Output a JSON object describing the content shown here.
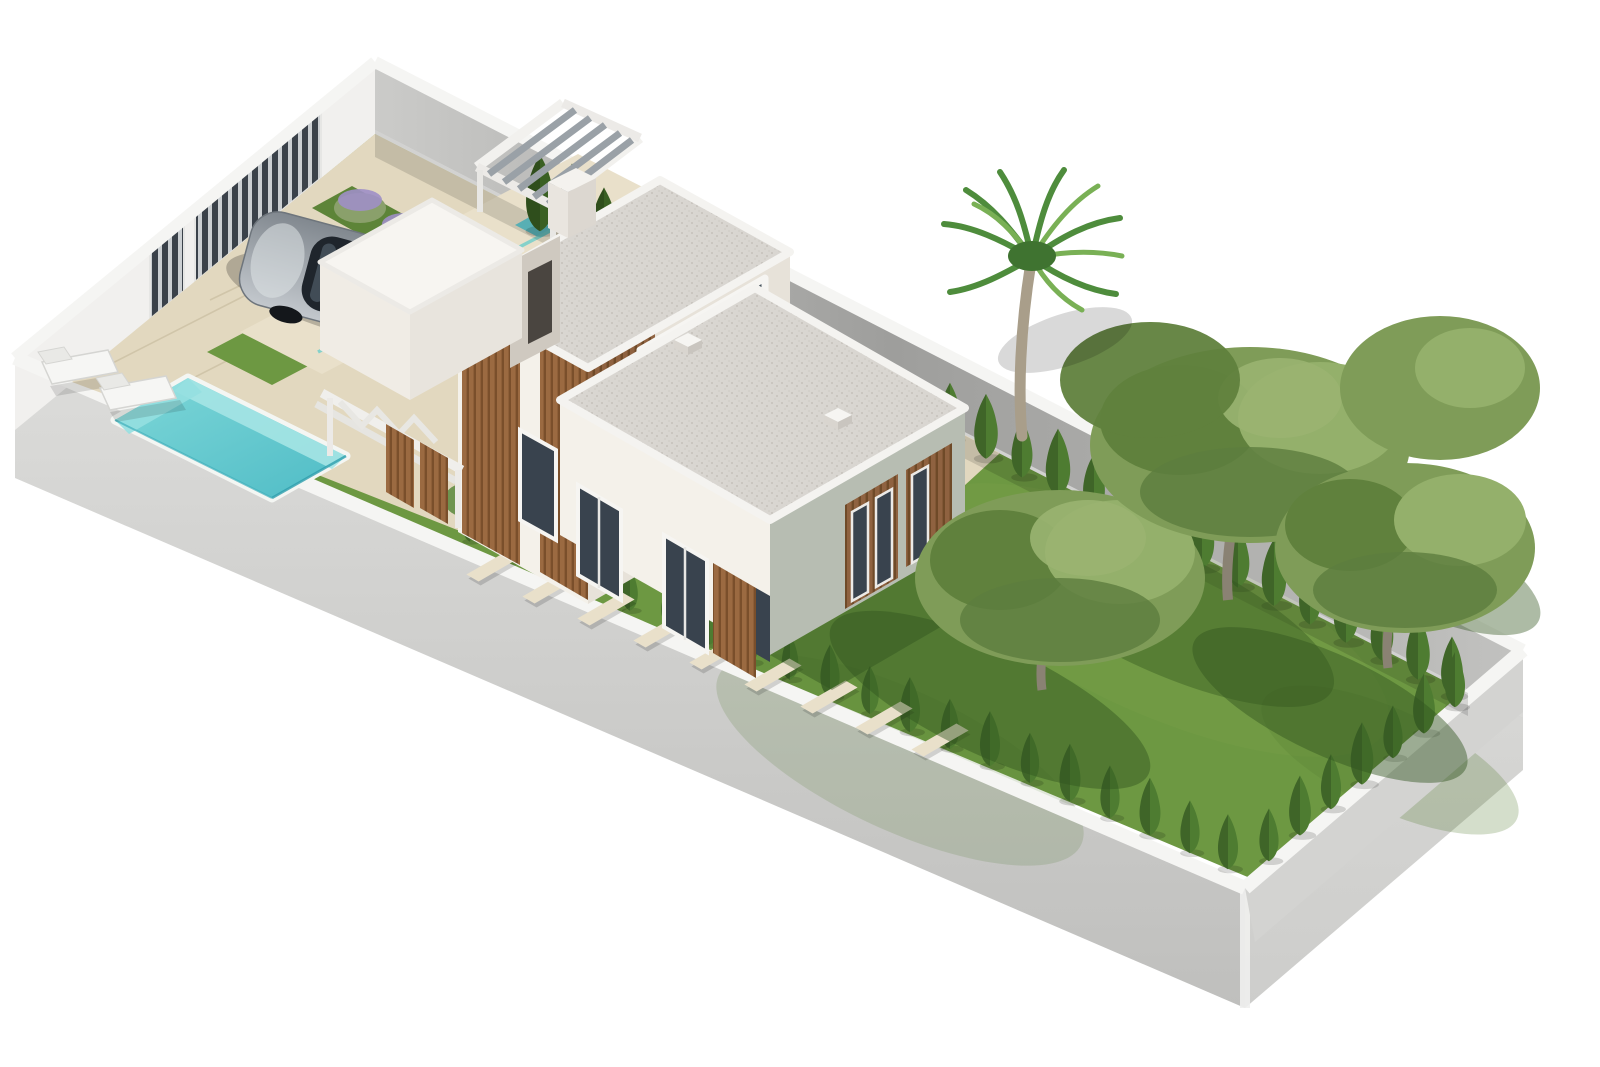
{
  "scene": {
    "description": "3D isometric architectural rendering of a modern two-storey villa on a long walled plot with driveway, parked car, entrance gates, swimming pool, sun loungers, lawns, cypress hedges, stepping-stone path, palm tree and pine trees",
    "colors": {
      "background": "#ffffff",
      "wallOuterLight": "#dcdcda",
      "wallOuterDark": "#bfbfbd",
      "wallOuterSide": "#cdcdcb",
      "coping": "#f5f5f3",
      "wallInnerLit": "#f1f0ee",
      "wallInnerShade": "#b2b2b0",
      "gateSlat": "#3b424a",
      "gateGap": "#ccd0d3",
      "grass": "#6d9842",
      "grassLight": "#7ea94f",
      "grassShadow": "#31551f",
      "paving": "#e2d8bf",
      "pavingLight": "#e9e0ca",
      "pavingJoint": "#c9bda0",
      "poolRim": "#f4f6f3",
      "poolWater": "#7ed7d8",
      "poolWaterDeep": "#4fbcc6",
      "poolWall": "#a5e4e4",
      "houseWhite": "#f4f1ea",
      "houseShade": "#e7e2d9",
      "houseSideGrey": "#b7bdb2",
      "gravelRoof": "#d9d6d1",
      "gravelDot": "#c5c1bb",
      "woodSlat": "#9b6a41",
      "woodSlatDark": "#7a4f2b",
      "windowGlass": "#39434e",
      "frameWhite": "#f6f5f2",
      "pergolaBeam": "#9aa1a7",
      "hedge": "#4e7c31",
      "hedgeDark": "#3a6023",
      "treeCanopy": "#7f9c58",
      "treeCanopyDark": "#60813d",
      "treeCanopyLight": "#94b06b",
      "treeTrunk": "#897f6e",
      "palmTrunk": "#a99e8a",
      "palmFrond": "#4e8c3c",
      "palmFrondLight": "#79b055",
      "carBody": "#c3c8cd",
      "carBodyDark": "#81888f",
      "carGlass": "#1f252c",
      "carTyre": "#14171b",
      "lavender": "#9e8fc6",
      "flowerOrange": "#d8823d",
      "flowerRed": "#c05540",
      "shadow": "#000000"
    }
  }
}
